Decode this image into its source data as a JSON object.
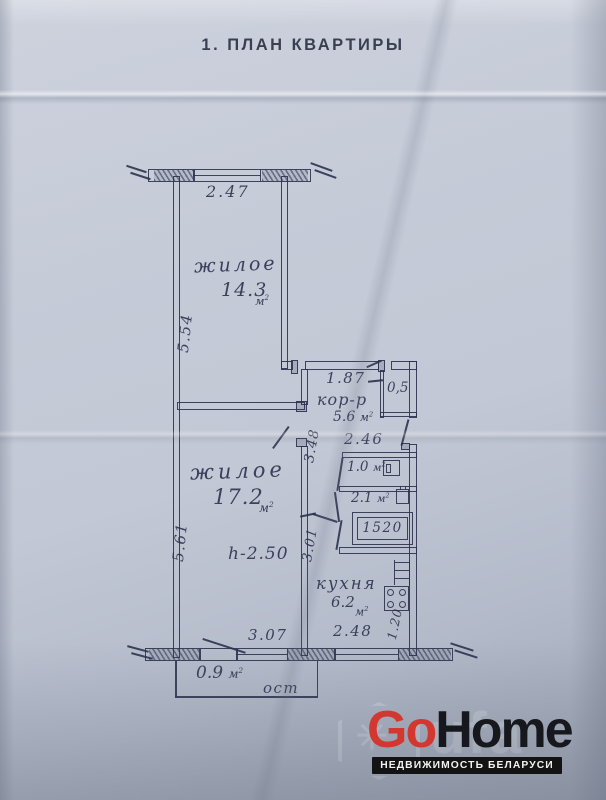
{
  "page": {
    "title": "1. ПЛАН КВАРТИРЫ"
  },
  "units": {
    "m": "м",
    "exp": "2"
  },
  "rooms": {
    "living1": {
      "label": "жилое",
      "area": "14.3"
    },
    "living2": {
      "label": "жилое",
      "area": "17.2"
    },
    "corridor": {
      "label": "кор-р",
      "area": "5.6"
    },
    "kitchen": {
      "label": "кухня",
      "area": "6.2"
    },
    "wc": {
      "area": "1.0"
    },
    "bath": {
      "area": "2.1"
    },
    "closet": {
      "area": "0,5"
    },
    "balcony": {
      "area": "0.9",
      "label": "ост"
    }
  },
  "dims": {
    "top_width": "2.47",
    "living1_height": "5.54",
    "corridor_top": "1.87",
    "corridor_width": "2.46",
    "passage_upper": "3.48",
    "passage_lower": "3.01",
    "living2_height": "5.61",
    "living2_width": "3.07",
    "kitchen_width": "2.48",
    "kitchen_depth": "1.20",
    "ceiling_height": "h-2.50",
    "bath_length": "1520"
  },
  "footer": {
    "brand_part1": "Go",
    "brand_part2": "Home",
    "tagline": "НЕДВИЖИМОСТЬ БЕЛАРУСИ",
    "accent_color": "#d23730"
  }
}
